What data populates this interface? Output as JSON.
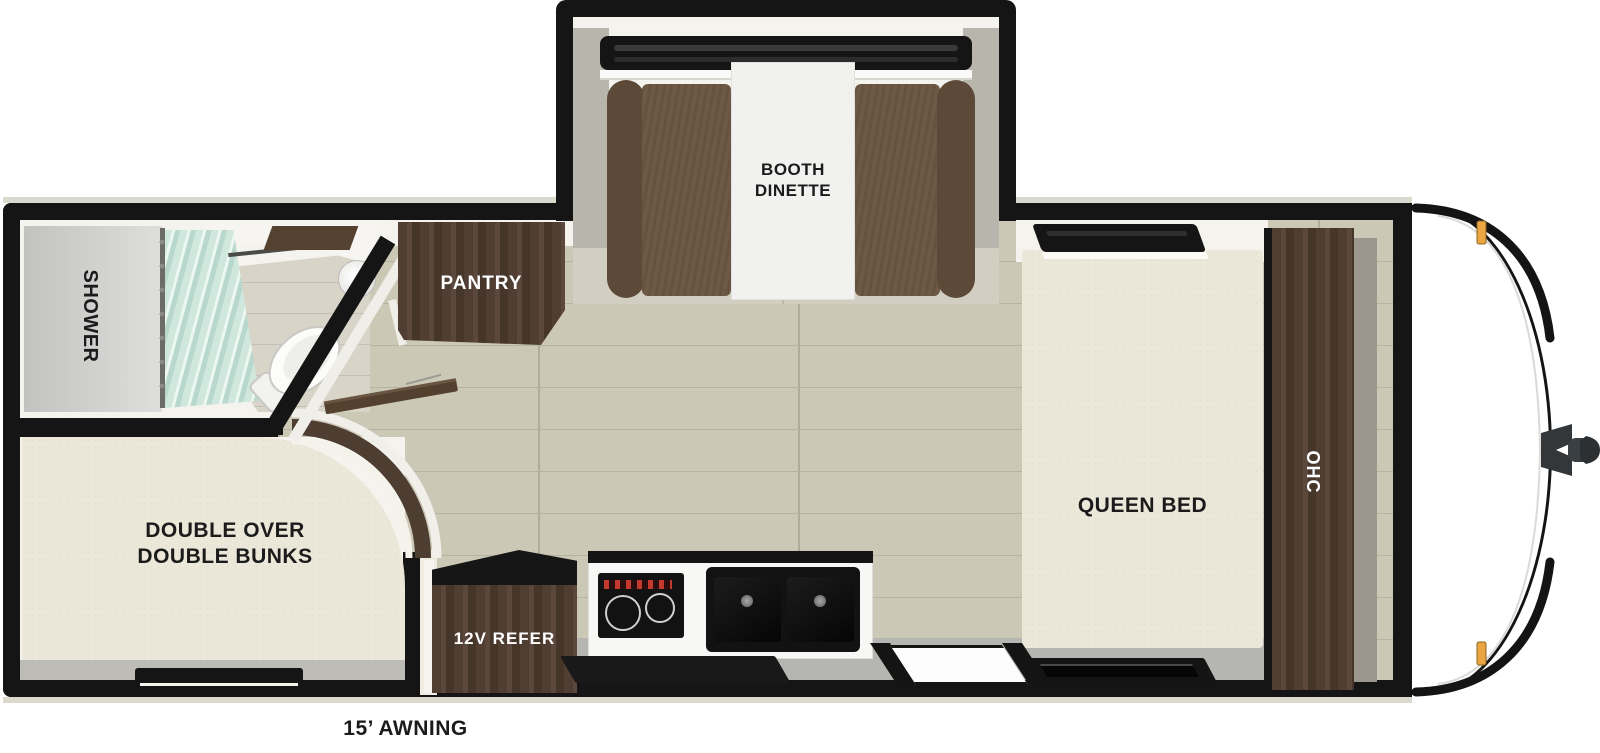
{
  "floorplan": {
    "labels": {
      "booth_line1": "BOOTH",
      "booth_line2": "DINETTE",
      "pantry": "PANTRY",
      "shower": "SHOWER",
      "bunks_line1": "DOUBLE OVER",
      "bunks_line2": "DOUBLE BUNKS",
      "refer": "12V REFER",
      "queen_bed": "QUEEN BED",
      "ohc": "OHC",
      "awning": "15’ AWNING"
    },
    "colors": {
      "wall": "#151515",
      "floor": "#ccc8b6",
      "plankline": "#b7b3a2",
      "interior": "#f4f3ee",
      "beigeband": "#d2cfc2",
      "grayfloor": "#b5b5b1",
      "mattress": "#ebe8d9",
      "bench": "#6d5945",
      "benchback": "#5c4938",
      "cabinet": "#4e3c31",
      "table": "#f1f1ef",
      "curtain": "#cfe7dd",
      "showergray": "#c6c6c4",
      "amber": "#eaa640",
      "counter": "#f7f7f5",
      "appliance": "#121212",
      "sidewall": "#b8b5ad"
    }
  }
}
